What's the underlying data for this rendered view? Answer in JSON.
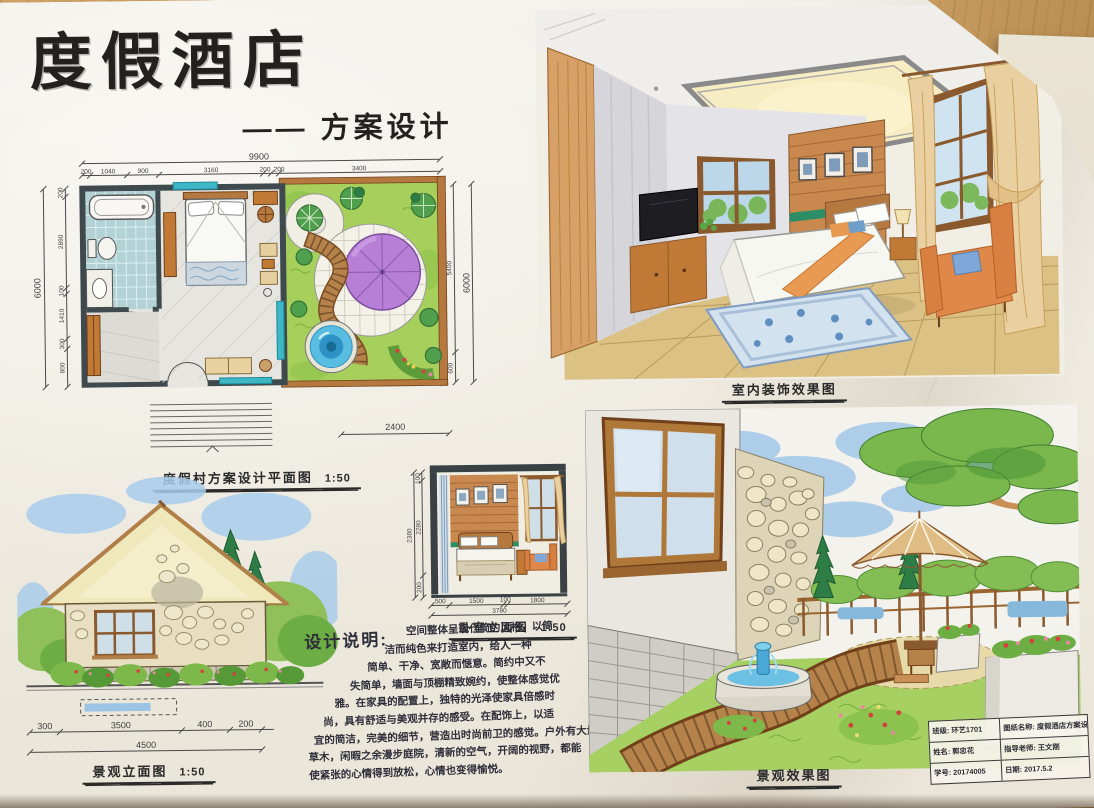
{
  "palette": {
    "ink": "#2b2b2b",
    "wall": "#3e4a4e",
    "teal": "#3db6c6",
    "wood": "#c0803c",
    "lawn": "#a6cf5b",
    "umbrella_purple": "#b77fd6",
    "pond_blue": "#45b6de",
    "sky_blue": "#9cc3e8",
    "curtain_tan": "#ead0a0",
    "chair_orange": "#e0884a",
    "roof_cream": "#efe8bb"
  },
  "page": {
    "title": "度假酒店",
    "subtitle": "—— 方案设计"
  },
  "floor_plan": {
    "label": "度假村方案设计平面图",
    "scale": "1:50",
    "dim_total_top": "9900",
    "dims_top": [
      "200",
      "1040",
      "900",
      "3160",
      "200",
      "200",
      "3400"
    ],
    "dim_total_left": "6000",
    "dims_left": [
      "200",
      "2890",
      "100",
      "1410",
      "300",
      "800"
    ],
    "dims_right": [
      "5400",
      "600"
    ],
    "dim_total_right": "6000",
    "dim_deck": "2400"
  },
  "interior_render": {
    "label": "室内装饰效果图"
  },
  "bedroom_elevation": {
    "label": "卧室立面图",
    "scale": "1:50",
    "dim_total_left": "2380",
    "dims_left": [
      "100",
      "2280",
      "200"
    ],
    "dims_bottom": [
      "500",
      "1500",
      "100",
      "1800"
    ],
    "dim_total_bottom": "3780"
  },
  "landscape_elevation": {
    "label": "景观立面图",
    "scale": "1:50",
    "dims_top": [
      "300",
      "3500",
      "400",
      "200"
    ],
    "dim_total": "4500"
  },
  "design_notes": {
    "heading": "设计说明:",
    "lines": [
      "空间整体呈现代简约风格，以简",
      "洁而纯色来打造室内，给人一种",
      "简单、干净、宽敞而惬意。简约中又不",
      "失简单，墙面与顶棚精致婉约，使整体感觉优",
      "雅。在家具的配置上，独特的光泽使家具倍感时",
      "尚，具有舒适与美观并存的感受。在配饰上，以适",
      "宜的简洁，完美的细节，营造出时尚前卫的感觉。户外有大量",
      "草木，闲暇之余漫步庭院，清新的空气，开阔的视野，都能",
      "使紧张的心情得到放松，心情也变得愉悦。"
    ]
  },
  "landscape_render": {
    "label": "景观效果图"
  },
  "title_block": {
    "class_label": "班级:",
    "class_value": "环艺1701",
    "drawing_label": "图纸名称:",
    "drawing_value": "度假酒店方案设计",
    "name_label": "姓名:",
    "name_value": "郭忠花",
    "advisor_label": "指导老师:",
    "advisor_value": "王文刚",
    "id_label": "学号:",
    "id_value": "20174005",
    "date_label": "日期:",
    "date_value": "2017.5.2"
  }
}
